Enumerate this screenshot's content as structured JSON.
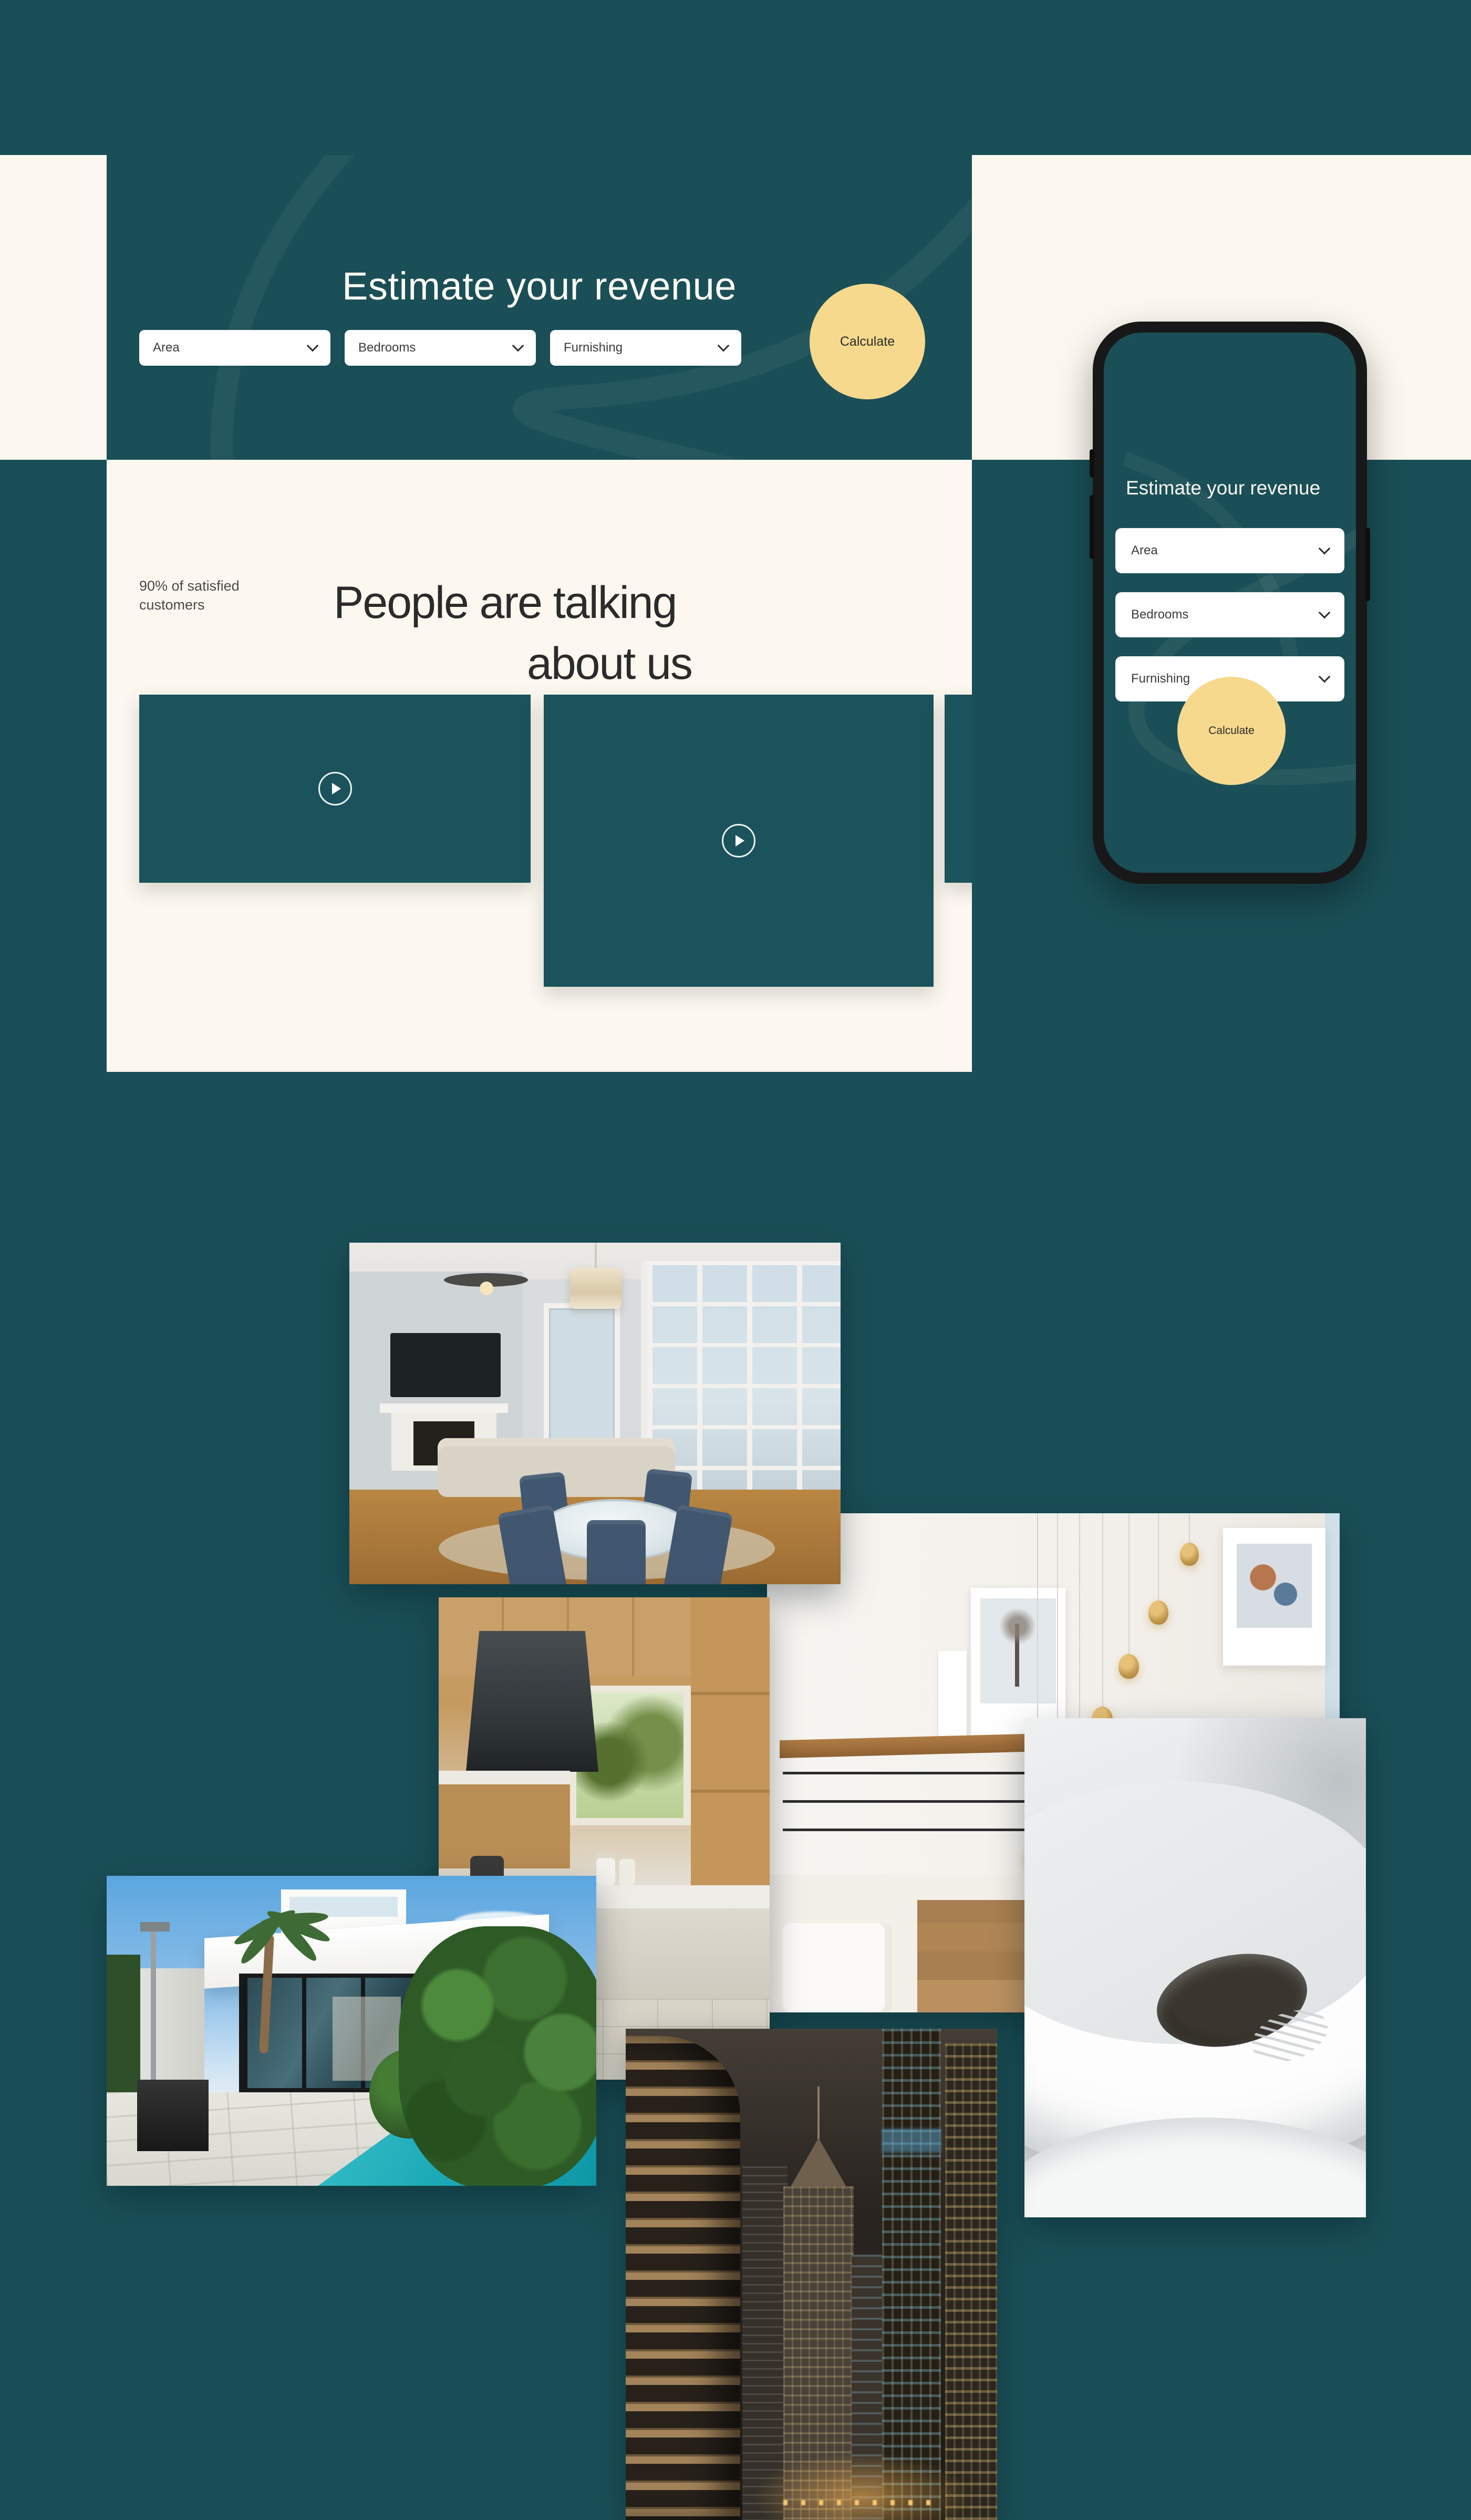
{
  "colors": {
    "teal_background": "#1A4F57",
    "teal_card": "#1B535C",
    "cream": "#FCF8F0",
    "accent_yellow": "#F7D98D",
    "heading_dark": "#2B2B2B",
    "white_text": "#FDFBF4"
  },
  "icons": {
    "chevron_down": "css-chevron (rotated square corner)",
    "play": "css-triangle in outlined circle"
  },
  "hero": {
    "title": "Estimate your revenue",
    "area_label": "Area",
    "bedrooms_label": "Bedrooms",
    "furnishing_label": "Furnishing",
    "calculate_label": "Calculate"
  },
  "phone": {
    "title": "Estimate your revenue",
    "area_label": "Area",
    "bedrooms_label": "Bedrooms",
    "furnishing_label": "Furnishing",
    "calculate_label": "Calculate"
  },
  "testimonials": {
    "stat": "90% of satisfied customers",
    "title_line1": "People are talking",
    "title_line2": "about us"
  },
  "gallery": {
    "photos": [
      {
        "name": "living-dining-room"
      },
      {
        "name": "staircase-pendant-lights"
      },
      {
        "name": "wooden-kitchen"
      },
      {
        "name": "white-spiral-staircase"
      },
      {
        "name": "villa-with-pool"
      },
      {
        "name": "night-skyscrapers"
      }
    ]
  }
}
